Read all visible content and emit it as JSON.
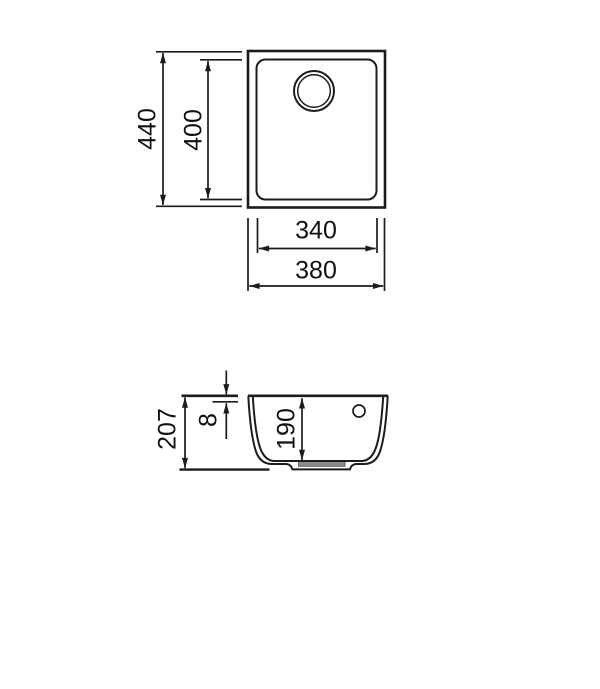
{
  "drawing": {
    "dimensions": {
      "top_view": {
        "overall_height": "440",
        "bowl_height": "400",
        "bowl_width": "340",
        "overall_width": "380"
      },
      "section_view": {
        "total_depth": "207",
        "rim_height": "8",
        "bowl_depth": "190"
      }
    },
    "colors": {
      "line": "#1c1c1c",
      "drain_strainer_fill": "#8c8c8c",
      "background": "#ffffff"
    }
  }
}
